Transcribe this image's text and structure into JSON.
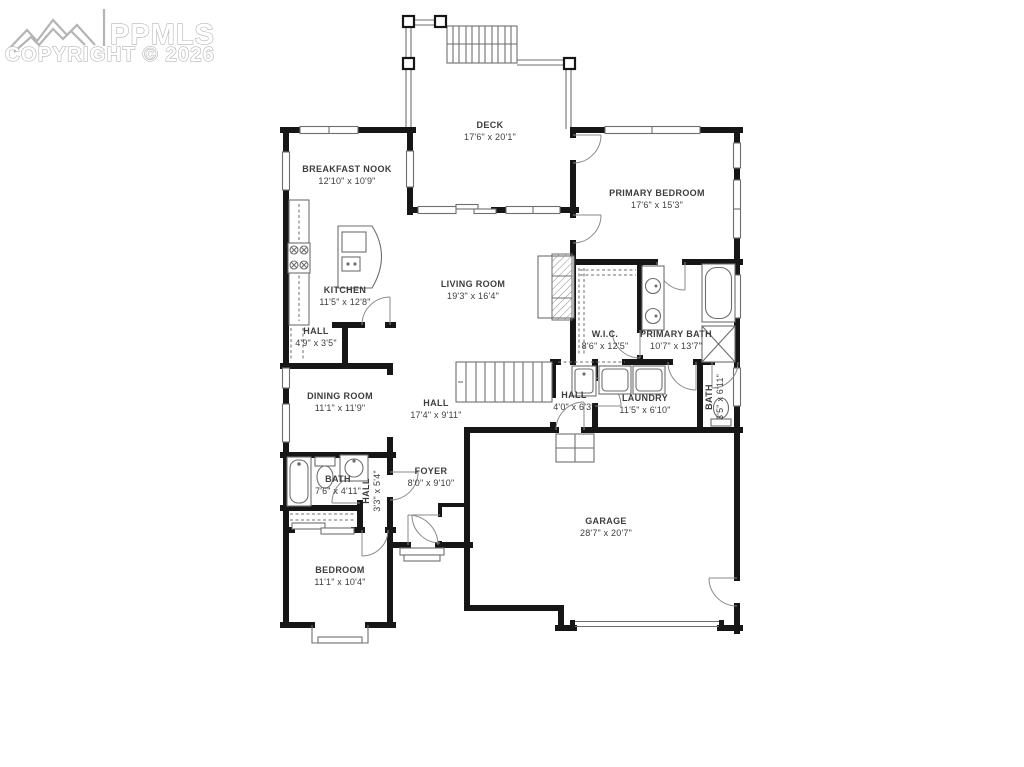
{
  "watermark": {
    "brand": "PPMLS",
    "copyright": "COPYRIGHT © 2026",
    "logo": "mountain-logo"
  },
  "colors": {
    "wall": "#161616",
    "line": "#6e6e6e",
    "watermark": "#a8a8a8",
    "text": "#3d3d3d",
    "background": "#ffffff"
  },
  "rooms": {
    "deck": {
      "name": "DECK",
      "dims": "17'6\" x 20'1\""
    },
    "breakfast_nook": {
      "name": "BREAKFAST NOOK",
      "dims": "12'10\" x 10'9\""
    },
    "primary_bedroom": {
      "name": "PRIMARY BEDROOM",
      "dims": "17'6\" x 15'3\""
    },
    "kitchen": {
      "name": "KITCHEN",
      "dims": "11'5\" x 12'8\""
    },
    "living_room": {
      "name": "LIVING ROOM",
      "dims": "19'3\" x 16'4\""
    },
    "wic": {
      "name": "W.I.C.",
      "dims": "8'6\" x 12'5\""
    },
    "primary_bath": {
      "name": "PRIMARY BATH",
      "dims": "10'7\" x 13'7\""
    },
    "hall_small": {
      "name": "HALL",
      "dims": "4'9\" x 3'5\""
    },
    "dining_room": {
      "name": "DINING ROOM",
      "dims": "11'1\" x 11'9\""
    },
    "hall_main": {
      "name": "HALL",
      "dims": "17'4\" x 9'11\""
    },
    "hall_laundry": {
      "name": "HALL",
      "dims": "4'0\" x 6'3\""
    },
    "laundry": {
      "name": "LAUNDRY",
      "dims": "11'5\" x 6'10\""
    },
    "bath_right": {
      "name": "BATH",
      "dims": "3'5\" x 6'11\""
    },
    "bath_left": {
      "name": "BATH",
      "dims": "7'6\" x 4'11\""
    },
    "hall_bedroom": {
      "name": "HALL",
      "dims": "3'3\" x 5'4\""
    },
    "foyer": {
      "name": "FOYER",
      "dims": "8'0\" x 9'10\""
    },
    "garage": {
      "name": "GARAGE",
      "dims": "28'7\" x 20'7\""
    },
    "bedroom": {
      "name": "BEDROOM",
      "dims": "11'1\" x 10'4\""
    }
  }
}
